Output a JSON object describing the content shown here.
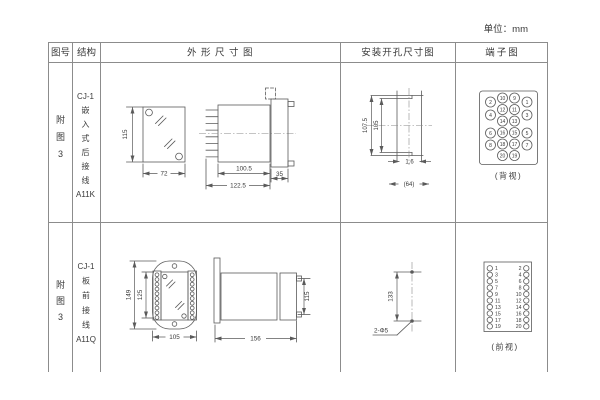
{
  "unit_label": "单位：mm",
  "header": {
    "figure_no": "图号",
    "structure": "结构",
    "outline": "外形尺寸图",
    "mounting": "安装开孔尺寸图",
    "terminal": "端子图"
  },
  "row1": {
    "figure_no_chars": [
      "附",
      "图",
      "3"
    ],
    "structure_lines": [
      "CJ-1",
      "嵌",
      "入",
      "式",
      "后",
      "接",
      "线",
      "A11K"
    ],
    "outline_dims": {
      "front_height": "115",
      "front_width": "72",
      "body_length": "100.5",
      "total_length": "122.5",
      "flange_depth": "35"
    },
    "mounting_dims": {
      "cutout_height_outer": "107.5",
      "cutout_height_inner": "105",
      "panel_thickness": "1.6",
      "ref_width": "(64)"
    },
    "terminal": {
      "view_label": "(背视)",
      "outer_left": [
        "2",
        "4",
        "6",
        "8"
      ],
      "inner_left": [
        "10",
        "12",
        "14",
        "16",
        "18",
        "20"
      ],
      "inner_right": [
        "9",
        "11",
        "13",
        "15",
        "17",
        "19"
      ],
      "outer_right": [
        "1",
        "3",
        "5",
        "7"
      ]
    }
  },
  "row2": {
    "figure_no_chars": [
      "附",
      "图",
      "3"
    ],
    "structure_lines": [
      "CJ-1",
      "板",
      "前",
      "接",
      "线",
      "A11Q"
    ],
    "outline_dims": {
      "front_height_outer": "149",
      "front_height_inner": "125",
      "front_width": "105",
      "side_length": "156",
      "side_height": "115"
    },
    "mounting_dims": {
      "hole_spacing": "133",
      "holes_label": "2-Φ5"
    },
    "terminal": {
      "view_label": "(前视)",
      "pairs": [
        [
          "1",
          "2"
        ],
        [
          "3",
          "4"
        ],
        [
          "5",
          "6"
        ],
        [
          "7",
          "8"
        ],
        [
          "9",
          "10"
        ],
        [
          "11",
          "12"
        ],
        [
          "13",
          "14"
        ],
        [
          "15",
          "16"
        ],
        [
          "17",
          "18"
        ],
        [
          "19",
          "20"
        ]
      ]
    }
  }
}
